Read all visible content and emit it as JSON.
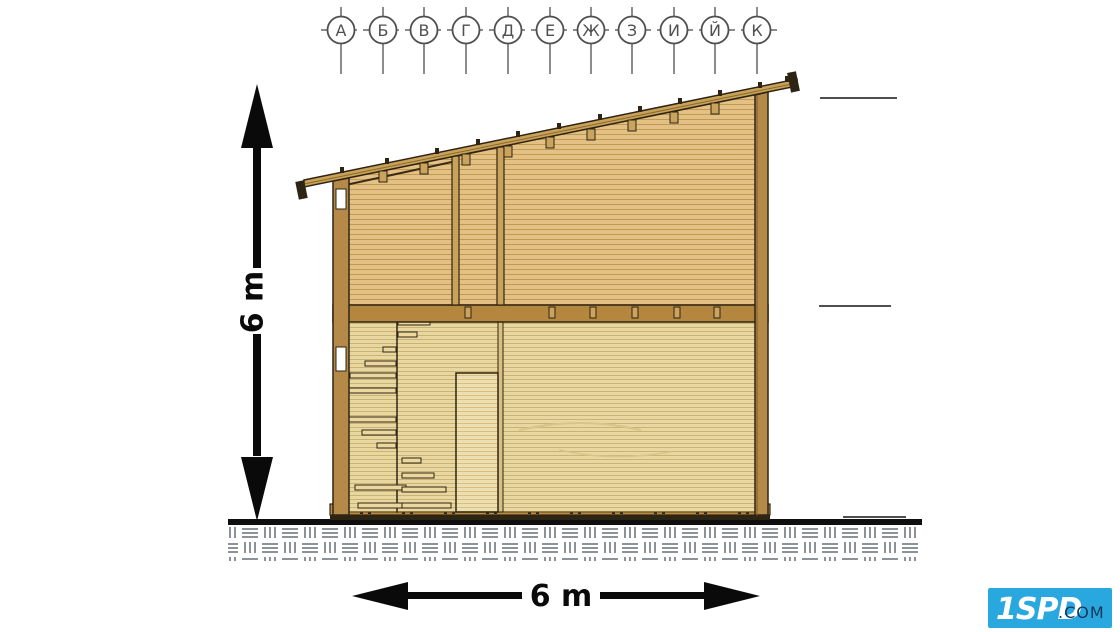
{
  "page": {
    "background": "#ffffff",
    "description_labels_visible": "technical section drawing of a timber house"
  },
  "grid_axis": {
    "labels": [
      "А",
      "Б",
      "В",
      "Г",
      "Д",
      "Е",
      "Ж",
      "З",
      "И",
      "Й",
      "К"
    ]
  },
  "dimensions": {
    "height_label": "6 m",
    "width_label": "6 m"
  },
  "logo": {
    "brand": "1SPD",
    "suffix": ".COM"
  },
  "colors": {
    "wall_plank_tan": "#e3c184",
    "wall_plank_light": "#e9d7a0",
    "timber_post": "#b58a48",
    "floor_band": "#b5873e",
    "base_band": "#ba8c42",
    "roof_band": "#c9a157",
    "outline_dark": "#2e2414",
    "grid_gray": "#4f4f4f",
    "ground_hatch_gray": "#8c9298",
    "dimension_black": "#0a0a0a",
    "logo_blue": "#29a8e0",
    "logo_text_dark": "#14365a"
  }
}
